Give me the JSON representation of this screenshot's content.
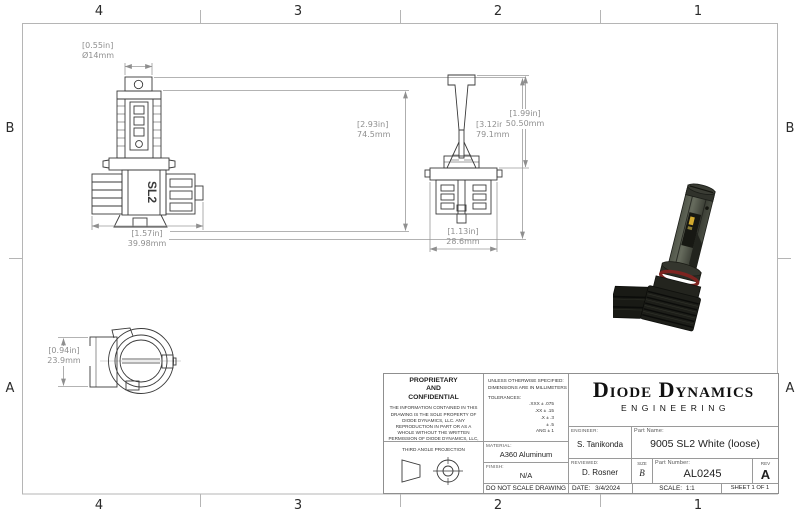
{
  "sheet": {
    "zones_cols": [
      "4",
      "3",
      "2",
      "1"
    ],
    "zones_rows": [
      "B",
      "A"
    ]
  },
  "views": {
    "front": {
      "marking": "SL2",
      "dims": {
        "diameter": {
          "in": "[0.55in]",
          "mm": "Ø14mm"
        },
        "body_height": {
          "in": "[2.93in]",
          "mm": "74.5mm"
        },
        "overall_height": {
          "in": "[3.12in]",
          "mm": "79.1mm"
        },
        "overall_width": {
          "in": "[1.57in]",
          "mm": "39.98mm"
        }
      }
    },
    "side": {
      "dims": {
        "upper_height": {
          "in": "[1.99in]",
          "mm": "50.50mm"
        },
        "base_width": {
          "in": "[1.13in]",
          "mm": "28.6mm"
        }
      }
    },
    "bottom": {
      "dims": {
        "side_depth": {
          "in": "[0.94in]",
          "mm": "23.9mm"
        }
      }
    }
  },
  "title_block": {
    "proprietary": {
      "line1": "PROPRIETARY",
      "line2": "AND",
      "line3": "CONFIDENTIAL",
      "body": "THE INFORMATION CONTAINED IN THIS DRAWING IS THE SOLE PROPERTY OF DIODE DYNAMICS, LLC.  ANY REPRODUCTION IN PART OR AS A WHOLE WITHOUT THE WRITTEN PERMISSION OF DIODE DYNAMICS, LLC, IS PROHIBITED."
    },
    "projection_label": "THIRD ANGLE PROJECTION",
    "specs": {
      "unless": "UNLESS OTHERWISE SPECIFIED:",
      "dims_note": "DIMENSIONS ARE IN MILLIMETERS",
      "tolerances_label": "TOLERANCES:",
      "tolerances": [
        ".XXX ± .075",
        ".XX ± .15",
        ".X ± .3",
        "± .5",
        "ANG ± 1"
      ],
      "material_label": "MATERIAL:",
      "material": "A360 Aluminum",
      "finish_label": "FINISH:",
      "finish": "N/A",
      "do_not_scale": "DO NOT SCALE DRAWING"
    },
    "company": {
      "name": "Diode Dynamics",
      "division": "ENGINEERING"
    },
    "fields": {
      "engineer_label": "ENGINEER:",
      "engineer": "S. Tanikonda",
      "part_name_label": "Part Name:",
      "part_name": "9005 SL2 White (loose)",
      "reviewed_label": "REVIEWED:",
      "reviewed": "D. Rosner",
      "size_label": "SIZE",
      "size": "B",
      "part_number_label": "Part Number:",
      "part_number": "AL0245",
      "rev_label": "REV",
      "rev": "A",
      "date_label": "DATE:",
      "date": "3/4/2024",
      "scale_label": "SCALE:",
      "scale": "1:1",
      "sheet": "SHEET 1 OF 1"
    }
  },
  "colors": {
    "drawing_line": "#3a3a3a",
    "dimension_gray": "#8f8f8f",
    "border_gray": "#b5b5b5",
    "oring_red": "#7d2420",
    "led_yellow": "#d2a92f",
    "render_body_gray": "#4e5347"
  }
}
